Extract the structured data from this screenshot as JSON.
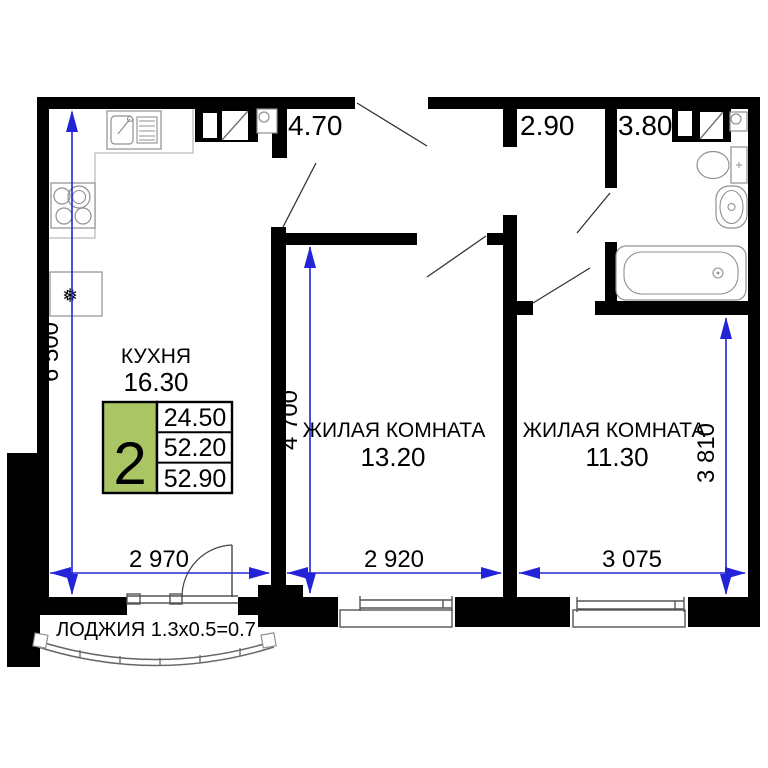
{
  "plan": {
    "type": "apartment-floor-plan",
    "rooms": {
      "kitchen": {
        "name": "КУХНЯ",
        "area": "16.30"
      },
      "room1": {
        "name": "ЖИЛАЯ КОМНАТА",
        "area": "13.20"
      },
      "room2": {
        "name": "ЖИЛАЯ КОМНАТА",
        "area": "11.30"
      },
      "hall": {
        "area": "4.70"
      },
      "corridor": {
        "area": "2.90"
      },
      "bathroom": {
        "area": "3.80"
      },
      "loggia": {
        "label": "ЛОДЖИЯ 1.3x0.5=0.7"
      }
    },
    "badge": {
      "rooms_count": "2",
      "living_area": "24.50",
      "total_area": "52.20",
      "total_area_with_loggia": "52.90"
    },
    "dims": {
      "kitchen_height": "6 500",
      "room1_height": "4 700",
      "room2_height": "3 810",
      "kitchen_width": "2 970",
      "room1_width": "2 920",
      "room2_width": "3 075"
    },
    "icons": {
      "fridge_snowflake": "❅"
    },
    "colors": {
      "walls": "#000000",
      "dimension_lines": "#2323d7",
      "badge_green": "#a9c564",
      "fixtures_stroke": "#909090",
      "background": "#ffffff"
    }
  }
}
